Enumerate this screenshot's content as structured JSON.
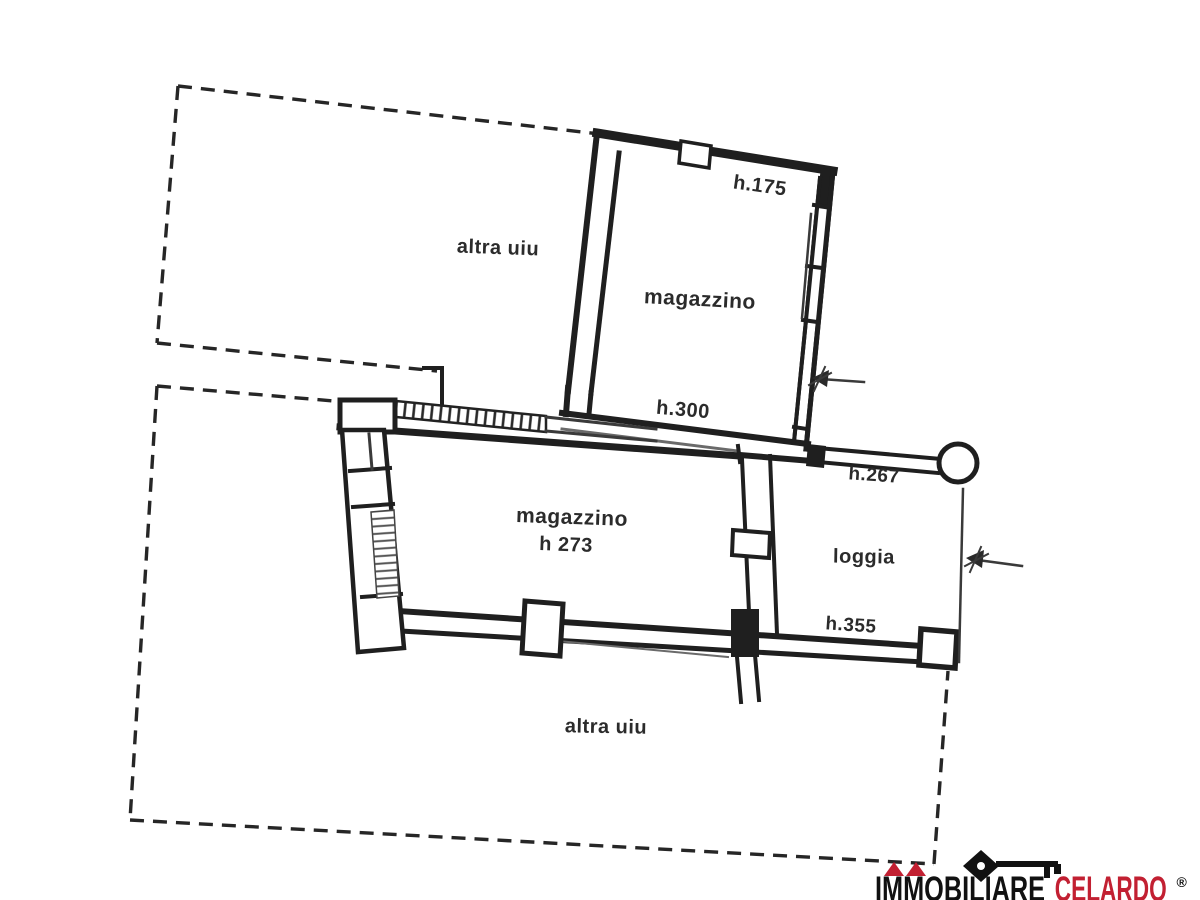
{
  "plan": {
    "labels": {
      "upper_area": "altra uiu",
      "upper_magazzino": "magazzino",
      "upper_magazzino_height": "h.175",
      "passage_height": "h.300",
      "central_magazzino": "magazzino",
      "central_magazzino_height": "h 273",
      "loggia": "loggia",
      "loggia_top_height": "h.267",
      "loggia_bottom_height": "h.355",
      "lower_area": "altra uiu"
    },
    "ink_color": "#1f1f1f",
    "background": "#ffffff"
  },
  "logo": {
    "brand_black": "IMMOBILIARE",
    "brand_red": "CELARDO",
    "registered_mark": "®",
    "accent_red": "#c22032"
  }
}
